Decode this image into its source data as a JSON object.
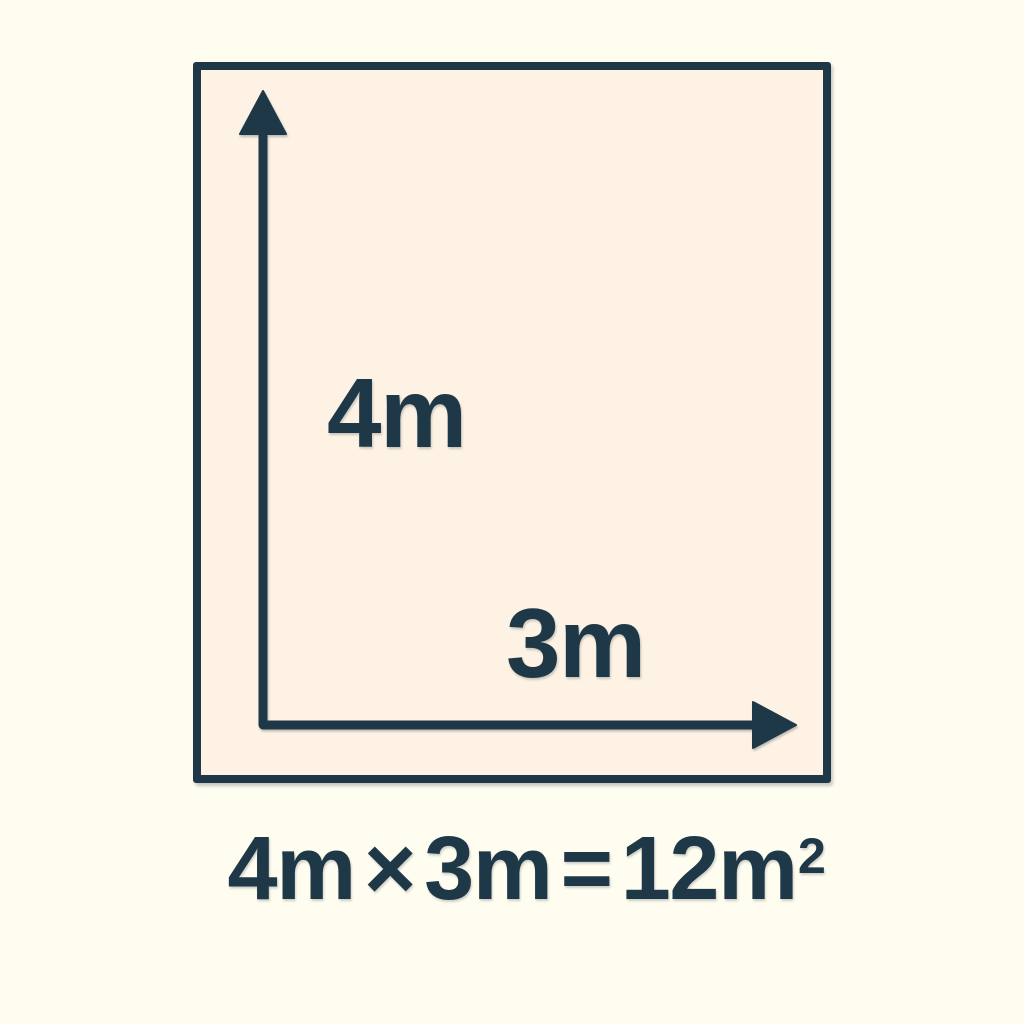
{
  "colors": {
    "background": "#FFFDF0",
    "rect_fill": "#FDF2E4",
    "ink": "#1F3848"
  },
  "diagram": {
    "height_label": "4m",
    "width_label": "3m"
  },
  "formula": {
    "term1": "4m",
    "operator": "×",
    "term2": "3m",
    "equals": "=",
    "result": "12m",
    "exponent": "2"
  }
}
